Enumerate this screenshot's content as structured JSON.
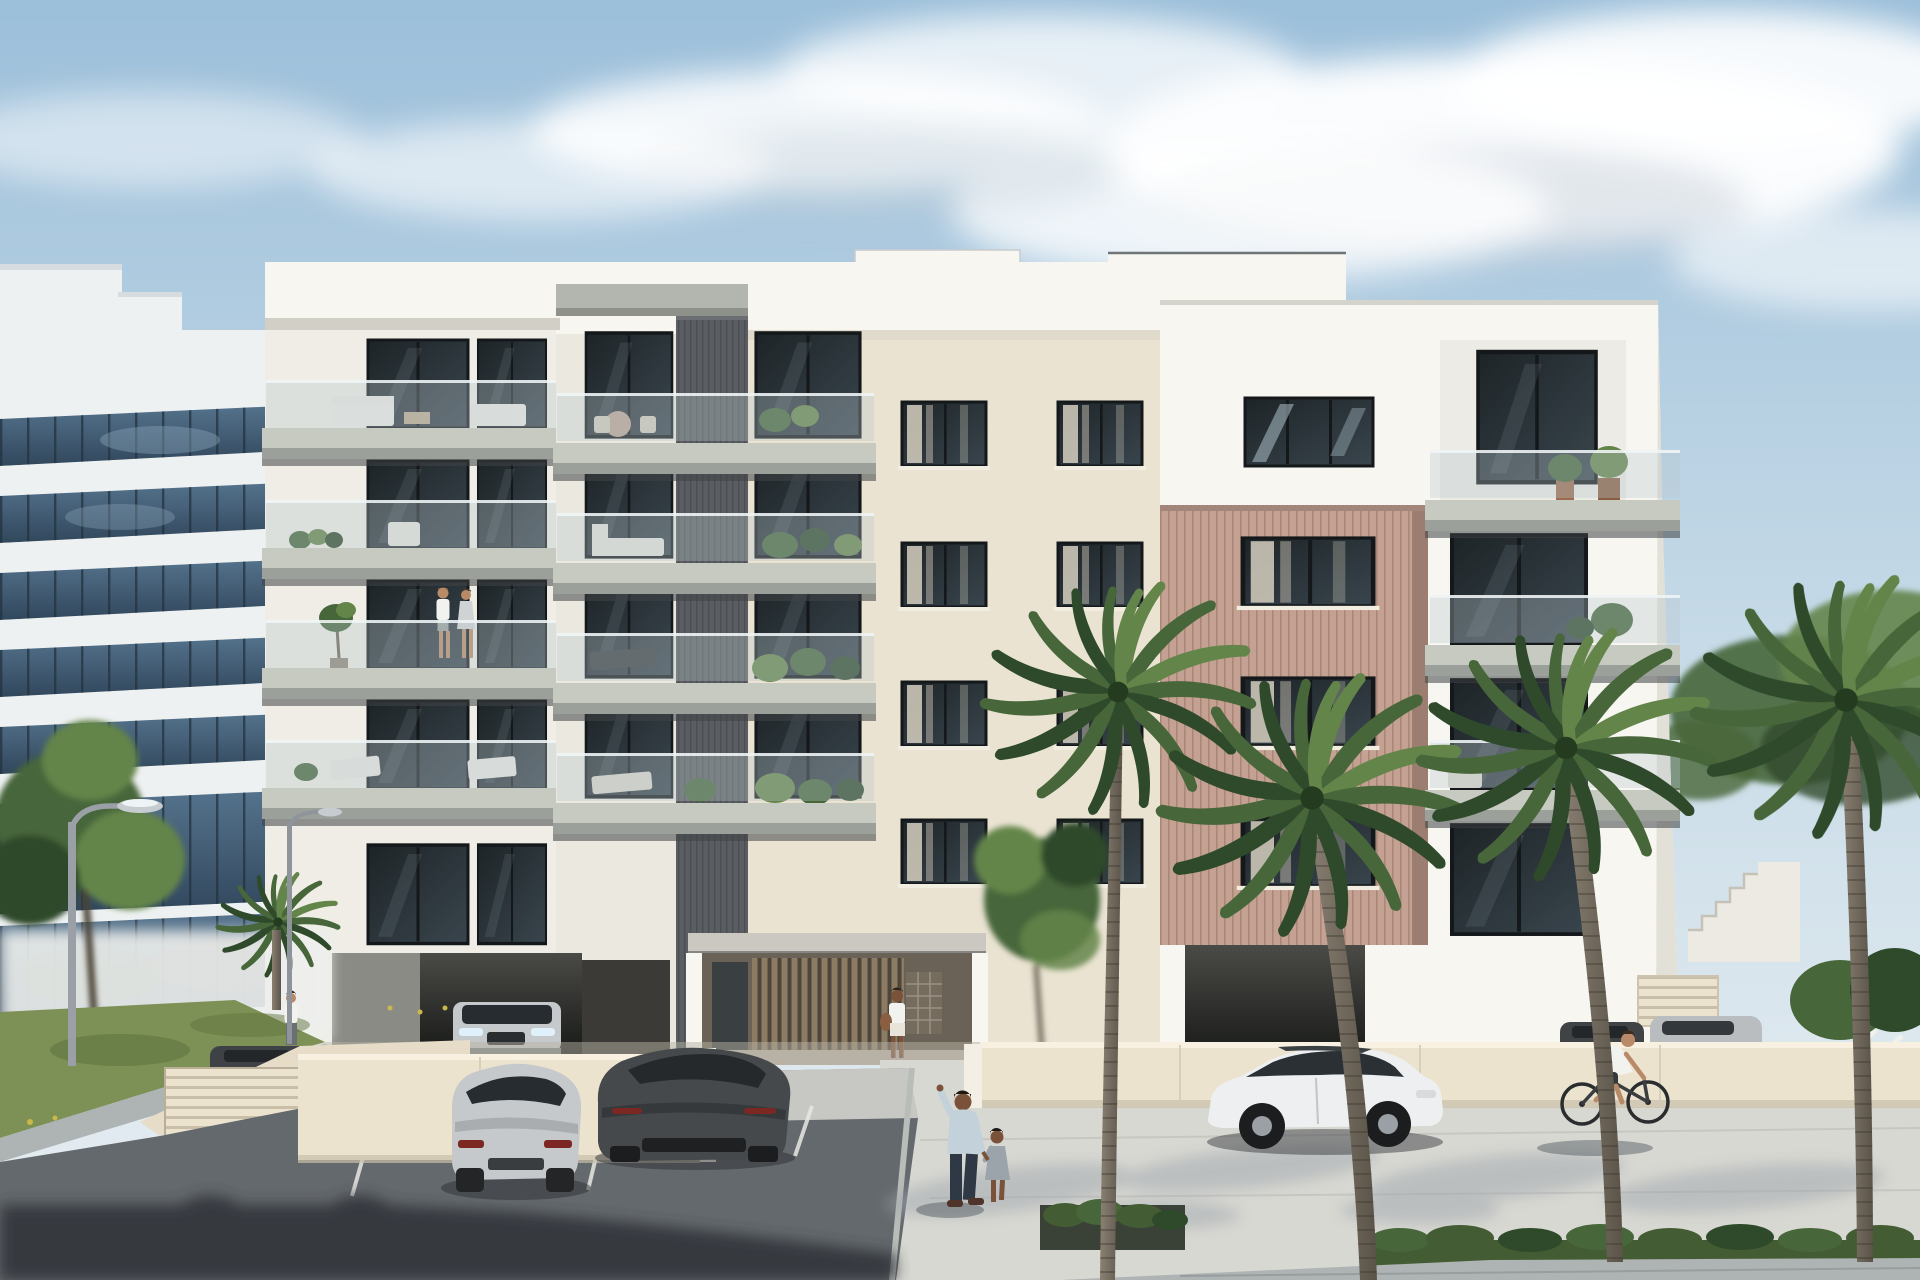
{
  "scene": {
    "title": "Architectural render: five-storey white apartment building with staggered balconies, palm-lined forecourt and parking lot",
    "time_of_day": "daytime, partly cloudy",
    "style": "photorealistic exterior visualization"
  },
  "colors": {
    "sky_top": "#9cbfda",
    "sky_mid": "#c6dae7",
    "sky_horizon": "#e9eff2",
    "cloud": "#ffffff",
    "cloud_shade": "#c3cdd7",
    "office_white": "#eef1f2",
    "office_shade": "#d7dce0",
    "office_glass": "#55738d",
    "office_glass_deep": "#31475c",
    "office_mullion": "#233240",
    "facade_white": "#f7f6f1",
    "facade_cream": "#eae3d2",
    "facade_shade": "#dfdacb",
    "parapet_shadow": "#d2d0c6",
    "slab_top": "#c7cac1",
    "slab_face": "#9ba09a",
    "slab_under": "#3f4446",
    "railing_glass": "#b8c8ce",
    "railing_edge": "#eef4f5",
    "win_dark": "#1d2427",
    "win_mid": "#39454d",
    "win_frame": "#14181a",
    "curtain": "#d6cfbf",
    "core_gray": "#5a5e62",
    "core_line": "#4b4f53",
    "wood": "#c4a192",
    "wood_line": "#a98878",
    "wood_shade": "#9c7e70",
    "entry_dark": "#4e463c",
    "entry_slat": "#8d7c64",
    "wall_cream": "#ece3cf",
    "wall_top": "#f8f1e1",
    "wall_shade": "#c9bfa9",
    "asphalt": "#64696d",
    "asphalt_dark": "#2e3337",
    "pavement": "#d8d8d2",
    "pavement_shade": "#9fa6ad",
    "sidewalk": "#aeb3b4",
    "grass": "#7d9055",
    "grass_dark": "#5f7440",
    "flower": "#c9b84a",
    "hedge": "#445c33",
    "leaf_dark": "#2f4a2b",
    "leaf_mid": "#47663a",
    "leaf_light": "#64854a",
    "trunk_light": "#8a8173",
    "trunk_dark": "#5a5348",
    "car_silver": "#c6c9cb",
    "car_silver_dark": "#94989b",
    "car_dark": "#45494c",
    "car_white": "#edeff0",
    "car_glass": "#272c30",
    "tail_red": "#7c2722",
    "skin": "#b98a68",
    "skin_dark": "#7a523a",
    "shirt_white": "#f2f2ee",
    "shirt_blue": "#c3d2da",
    "pants_dark": "#2f3945",
    "dress_gray": "#9ba4ab",
    "metal": "#9aa0a5",
    "stair": "#eceae2",
    "garage_dark": "#171917",
    "garage_mid": "#4a4a46"
  },
  "inventory": {
    "buildings": [
      {
        "name": "office-tower",
        "position": "left background",
        "facade": "white bands with blue glass curtain wall"
      },
      {
        "name": "apartment-building",
        "floors": 5,
        "balcony_levels": 4,
        "features": [
          "staggered concrete balcony slabs",
          "frameless glass railings",
          "charcoal textured feature core",
          "rose timber-slat feature panel",
          "two garage openings",
          "recessed entrance with timber slats and mailboxes",
          "external stair at right"
        ]
      }
    ],
    "vehicles": [
      {
        "type": "sedan",
        "color": "silver",
        "location": "inside left garage"
      },
      {
        "type": "coupe",
        "color": "silver",
        "location": "front parking space"
      },
      {
        "type": "sports-coupe",
        "color": "dark gray",
        "location": "front parking space"
      },
      {
        "type": "hatchback",
        "color": "white",
        "location": "curbside near palms"
      },
      {
        "type": "car",
        "color": "dark gray",
        "location": "behind right wall"
      },
      {
        "type": "sedan",
        "color": "silver",
        "location": "behind right wall"
      },
      {
        "type": "car",
        "color": "dark",
        "location": "behind left ramp gate"
      }
    ],
    "people": [
      {
        "who": "couple",
        "where": "third-floor balcony"
      },
      {
        "who": "woman with phone and bag",
        "where": "building entrance"
      },
      {
        "who": "man holding child's hand",
        "where": "walking across forecourt"
      },
      {
        "who": "cyclist",
        "where": "street in front of boundary wall"
      },
      {
        "who": "person",
        "where": "top of garage ramp"
      }
    ],
    "vegetation": {
      "palm_trees": 4,
      "young_palm": 1,
      "street_tree": 1,
      "hedge_strips": 2,
      "balcony_planting": "grasses, olive trees, potted shrubs"
    },
    "street": {
      "lamp_posts": 2,
      "parking_lines": 3,
      "boundary_walls": 2,
      "slatted_gate": 1
    }
  }
}
